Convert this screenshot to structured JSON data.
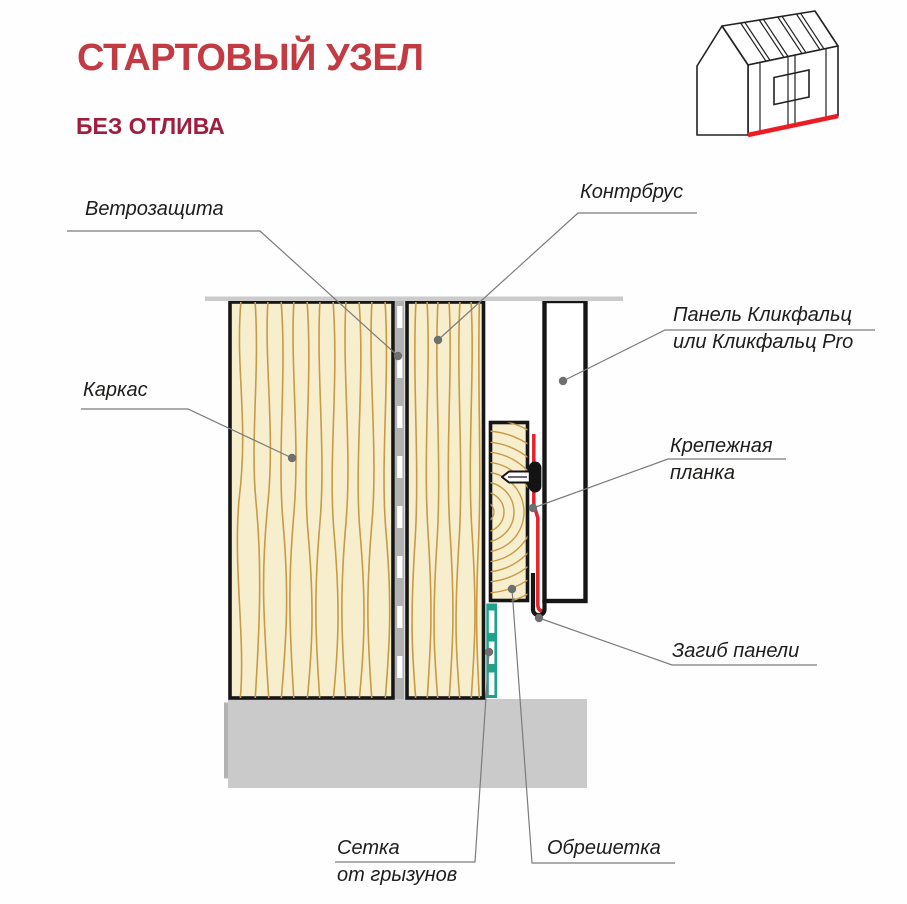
{
  "header": {
    "title": "СТАРТОВЫЙ УЗЕЛ",
    "subtitle": "БЕЗ ОТЛИВА"
  },
  "labels": {
    "windbarrier": "Ветрозащита",
    "counterbatten": "Контрбрус",
    "frame": "Каркас",
    "panel_line1": "Панель Кликфальц",
    "panel_line2": "или Кликфальц Pro",
    "fastener_line1": "Крепежная",
    "fastener_line2": "планка",
    "panel_bend": "Загиб панели",
    "mesh_line1": "Сетка",
    "mesh_line2": "от грызунов",
    "lathing": "Обрешетка"
  },
  "icons": {
    "house": "house-with-cladding-icon"
  },
  "colors": {
    "title_red": "#c23a42",
    "subtitle_red": "#a01d3e",
    "wood_fill": "#f7eecd",
    "wood_grain": "#c79a45",
    "outline_black": "#161616",
    "membrane_gray": "#b2b2b2",
    "foundation_gray": "#cacaca",
    "top_line_gray": "#cbcbcb",
    "mesh_teal": "#1fa18c",
    "fastener_red": "#e8212b",
    "house_red_line": "#ec1c24",
    "leader_gray": "#7b7b7b"
  }
}
